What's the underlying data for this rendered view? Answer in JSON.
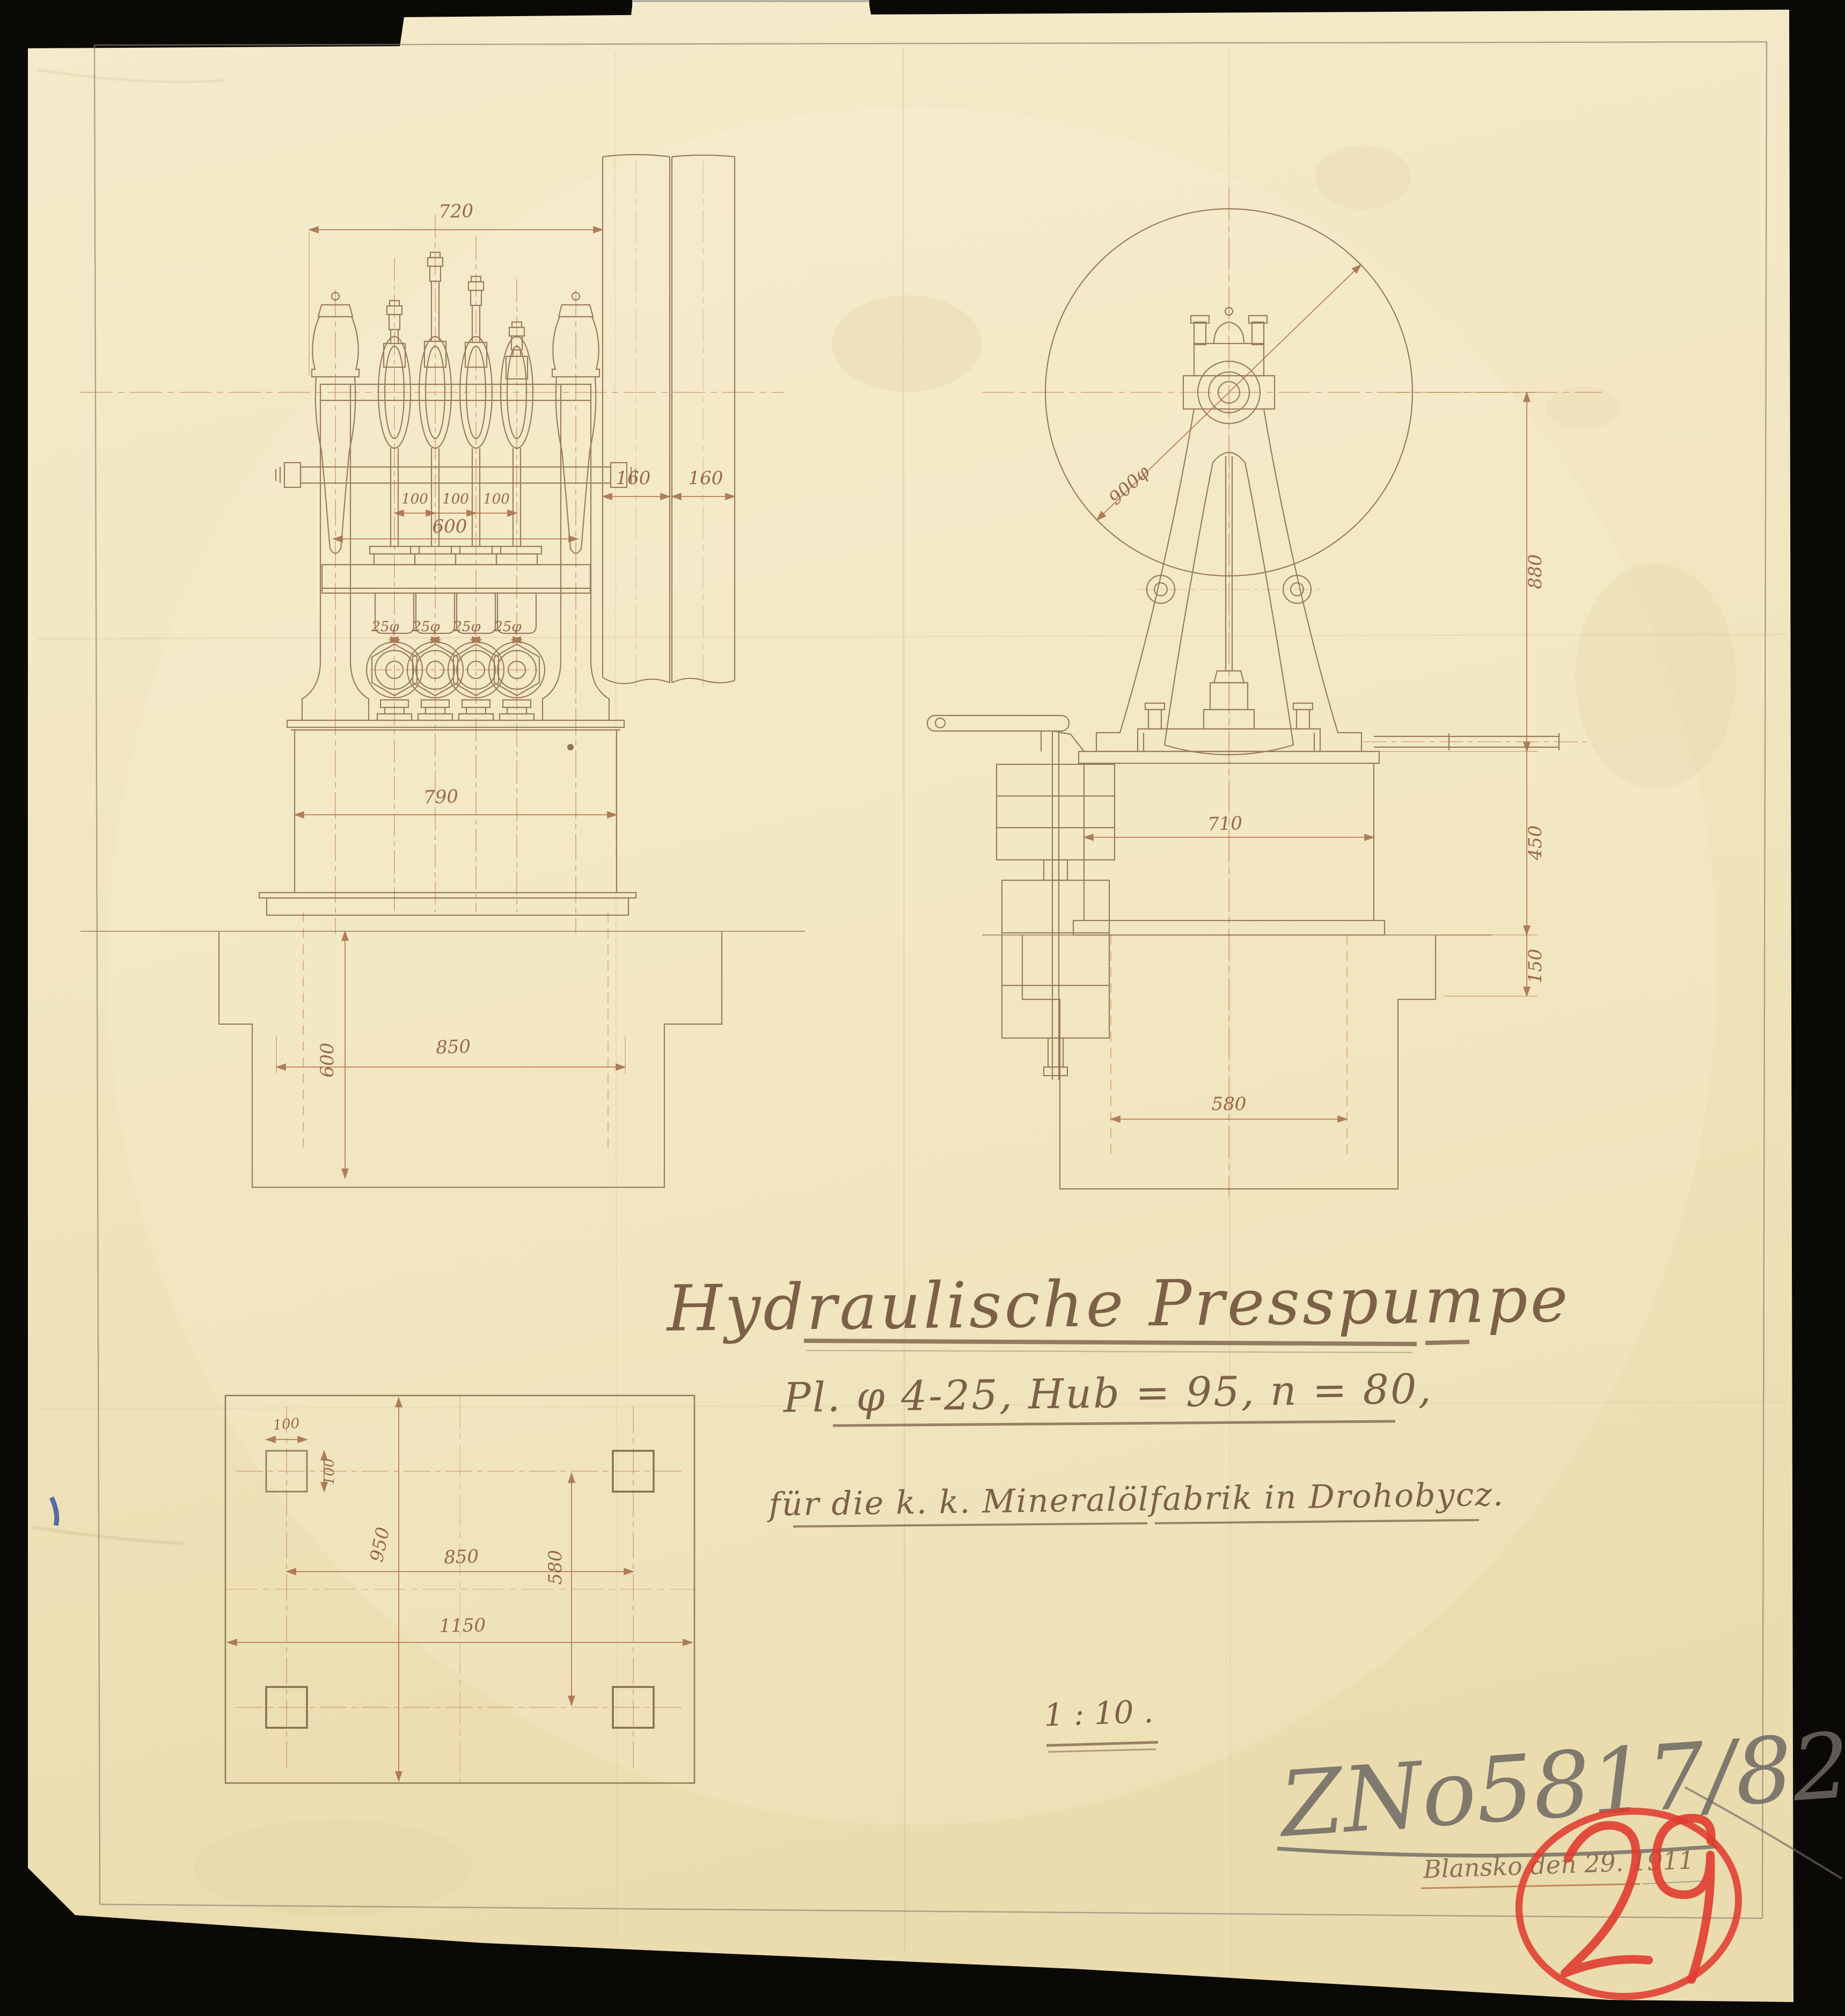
{
  "document": {
    "kind": "scanned archival technical drawing",
    "sheet_color": "#f1e7c4",
    "ink_color": "#8a6a4a",
    "dimension_color": "#b5714a",
    "centerline_color": "#c4714d",
    "pencil_color": "#6e6862",
    "crayon_color": "#e03c30"
  },
  "title_block": {
    "title": "Hydraulische Presspumpe",
    "spec_line": "Pl. φ 4-25, Hub = 95, n = 80,",
    "client_line": "für die k. k. Mineralölfabrik in Drohobycz.",
    "scale": "1 : 10 ."
  },
  "annotations": {
    "drawing_number": "ZNo5817/82",
    "place_date": "Blansko den 29. 1911",
    "sheet_number_red": "29"
  },
  "front_view": {
    "label": "front elevation of four-plunger press pump",
    "dims": {
      "overall_width": "720",
      "rim_left": "160",
      "rim_right": "160",
      "pitch_1": "100",
      "pitch_2": "100",
      "pitch_3": "100",
      "valve_span": "600",
      "plunger_1": "25φ",
      "plunger_2": "25φ",
      "plunger_3": "25φ",
      "plunger_4": "25φ",
      "body_width": "790",
      "foundation_width": "850",
      "foundation_depth": "600"
    }
  },
  "side_view": {
    "label": "side elevation with flywheel and weighted safety lever",
    "dims": {
      "flywheel_diameter": "900φ",
      "shaft_height": "880",
      "body_height": "450",
      "base_ledge": "150",
      "body_width": "710",
      "bolt_spacing": "580"
    }
  },
  "plan_view": {
    "label": "foundation plan with four anchor-bolt holes",
    "dims": {
      "bolt_hole_width": "100",
      "bolt_hole_height": "100",
      "bolt_span_horizontal": "850",
      "bolt_span_vertical": "580",
      "plate_depth": "950",
      "overall_width": "1150"
    }
  }
}
